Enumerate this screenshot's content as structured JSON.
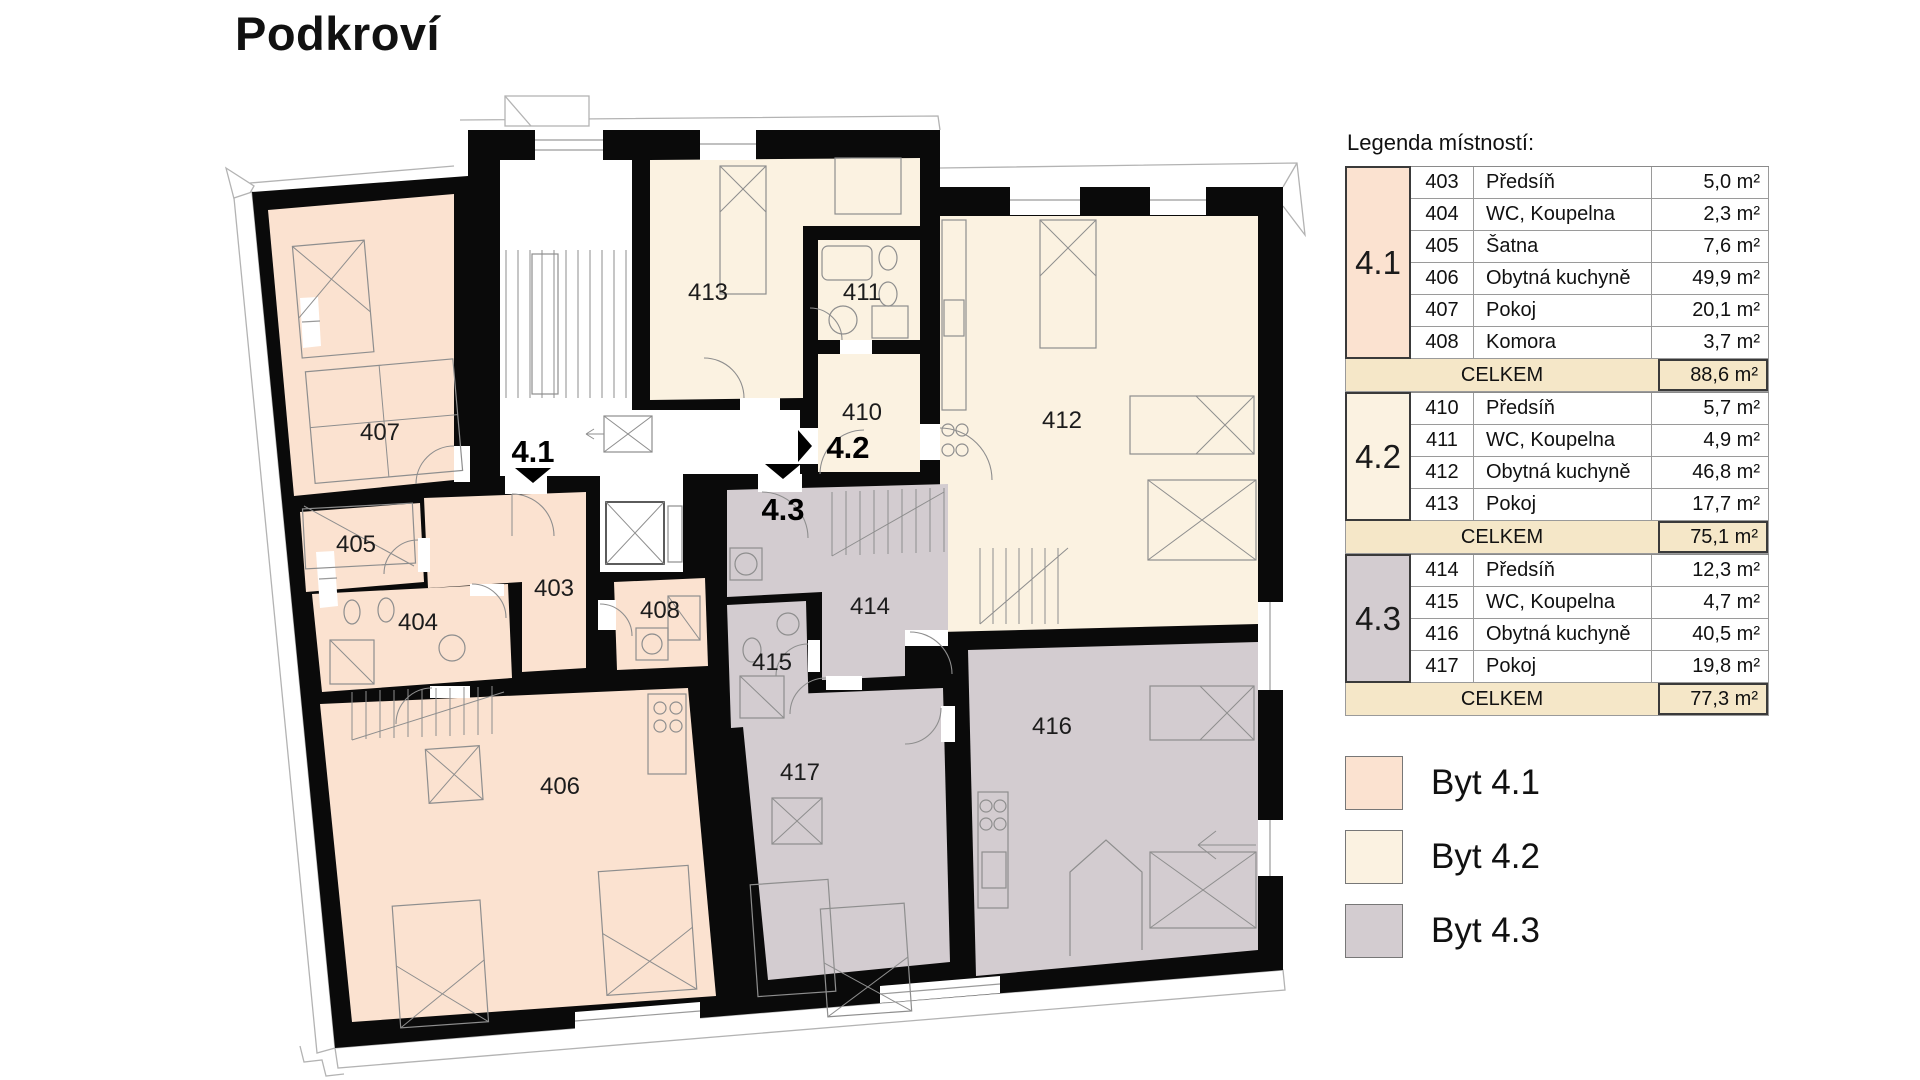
{
  "title": "Podkroví",
  "legend": {
    "heading": "Legenda místností:",
    "sections": [
      {
        "id": "4.1",
        "color": "#fbe2d0",
        "rows": [
          {
            "num": "403",
            "name": "Předsíň",
            "area": "5,0 m²"
          },
          {
            "num": "404",
            "name": "WC, Koupelna",
            "area": "2,3 m²"
          },
          {
            "num": "405",
            "name": "Šatna",
            "area": "7,6 m²"
          },
          {
            "num": "406",
            "name": "Obytná kuchyně",
            "area": "49,9 m²"
          },
          {
            "num": "407",
            "name": "Pokoj",
            "area": "20,1 m²"
          },
          {
            "num": "408",
            "name": "Komora",
            "area": "3,7 m²"
          }
        ],
        "total_label": "CELKEM",
        "total": "88,6 m²"
      },
      {
        "id": "4.2",
        "color": "#fbf2e1",
        "rows": [
          {
            "num": "410",
            "name": "Předsíň",
            "area": "5,7 m²"
          },
          {
            "num": "411",
            "name": "WC, Koupelna",
            "area": "4,9 m²"
          },
          {
            "num": "412",
            "name": "Obytná kuchyně",
            "area": "46,8 m²"
          },
          {
            "num": "413",
            "name": "Pokoj",
            "area": "17,7 m²"
          }
        ],
        "total_label": "CELKEM",
        "total": "75,1 m²"
      },
      {
        "id": "4.3",
        "color": "#d3ccd0",
        "rows": [
          {
            "num": "414",
            "name": "Předsíň",
            "area": "12,3 m²"
          },
          {
            "num": "415",
            "name": "WC, Koupelna",
            "area": "4,7 m²"
          },
          {
            "num": "416",
            "name": "Obytná kuchyně",
            "area": "40,5 m²"
          },
          {
            "num": "417",
            "name": "Pokoj",
            "area": "19,8 m²"
          }
        ],
        "total_label": "CELKEM",
        "total": "77,3 m²"
      }
    ]
  },
  "swatches": [
    {
      "label": "Byt 4.1",
      "color": "#fbe2d0"
    },
    {
      "label": "Byt 4.2",
      "color": "#fbf2e1"
    },
    {
      "label": "Byt 4.3",
      "color": "#d3ccd0"
    }
  ],
  "plan": {
    "rooms": [
      {
        "label": "407"
      },
      {
        "label": "405"
      },
      {
        "label": "404"
      },
      {
        "label": "403"
      },
      {
        "label": "408"
      },
      {
        "label": "406"
      },
      {
        "label": "413"
      },
      {
        "label": "411"
      },
      {
        "label": "410"
      },
      {
        "label": "412"
      },
      {
        "label": "414"
      },
      {
        "label": "415"
      },
      {
        "label": "417"
      },
      {
        "label": "416"
      }
    ],
    "apartments": [
      {
        "label": "4.1"
      },
      {
        "label": "4.2"
      },
      {
        "label": "4.3"
      }
    ]
  },
  "colors": {
    "wall": "#0a0a0a",
    "byt_41": "#fbe2d0",
    "byt_42": "#fbf2e1",
    "byt_43": "#d3ccd0",
    "total_row_bg": "#f5e7c8"
  }
}
